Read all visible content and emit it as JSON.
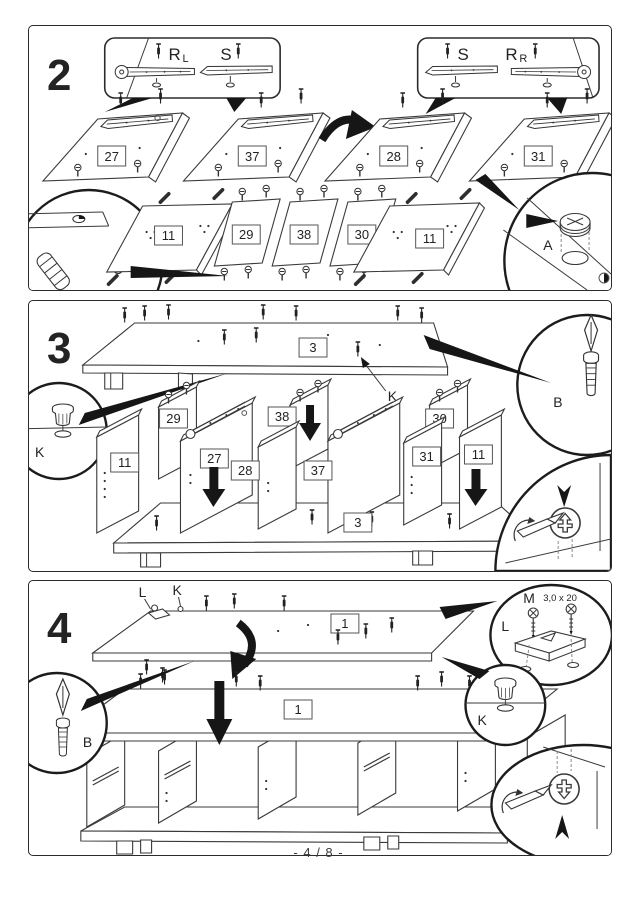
{
  "page": {
    "footer": "- 4 / 8 -"
  },
  "step2": {
    "number": "2",
    "callout_left": {
      "main": "R",
      "sub": "L",
      "second": "S"
    },
    "callout_right": {
      "first": "S",
      "main": "R",
      "sub": "R"
    },
    "panels_top": [
      {
        "label": "27"
      },
      {
        "label": "37"
      },
      {
        "label": "28"
      },
      {
        "label": "31"
      }
    ],
    "panels_bottom": [
      {
        "label": "11"
      },
      {
        "label": "29"
      },
      {
        "label": "38"
      },
      {
        "label": "30"
      },
      {
        "label": "11"
      }
    ],
    "detail_c": {
      "letter": "C"
    },
    "detail_a": {
      "letter": "A"
    }
  },
  "step3": {
    "number": "3",
    "top_panel_label": "3",
    "base_panel_label": "3",
    "pointer_k": "K",
    "detail_b": {
      "letter": "B"
    },
    "detail_k": {
      "letter": "K"
    },
    "dividers": [
      {
        "label": "29"
      },
      {
        "label": "11"
      },
      {
        "label": "27"
      },
      {
        "label": "28"
      },
      {
        "label": "38"
      },
      {
        "label": "37"
      },
      {
        "label": "30"
      },
      {
        "label": "31"
      },
      {
        "label": "11"
      }
    ]
  },
  "step4": {
    "number": "4",
    "top_label": "1",
    "assembly_label": "1",
    "fitting_l": "L",
    "fitting_k": "K",
    "detail_m": {
      "letter": "M",
      "spec": "3,0 x 20",
      "fitting": "L"
    },
    "detail_b": {
      "letter": "B"
    },
    "detail_k": {
      "letter": "K"
    }
  }
}
